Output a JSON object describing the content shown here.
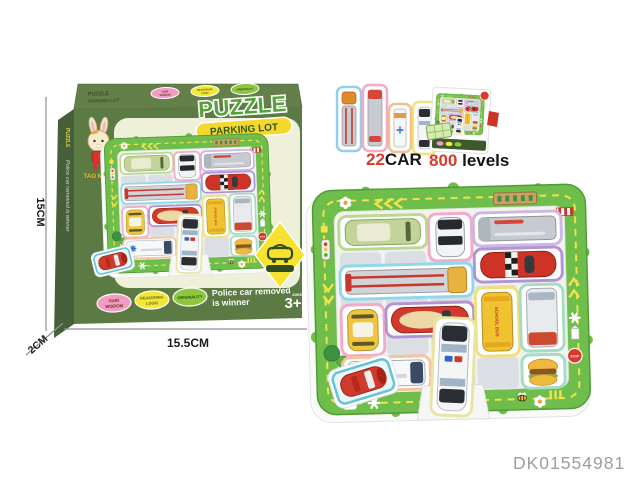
{
  "colors": {
    "box-olive": "#5c7a43",
    "box-olive-top": "#647f49",
    "box-olive-side": "#455f38",
    "box-cream": "#eef0da",
    "board-green": "#6fbe4b",
    "title-green": "#53a337",
    "ribbon-yellow": "#f6d72e",
    "red-accent": "#d93a2b",
    "code-gray": "#9b9ea2"
  },
  "product_code": "DK01554981",
  "box": {
    "title_line1": "PUZZLE",
    "title_line2": "PARKING LOT",
    "brand": "TAO MI TU",
    "side_text": "Police car removed is winner",
    "badges": [
      {
        "line1": "GAIN",
        "line2": "WISDOM",
        "color": "#f29bc4"
      },
      {
        "line1": "REASONING",
        "line2": "LOGIC",
        "color": "#f2e838"
      },
      {
        "line1": "ORIGINALITY",
        "line2": "",
        "color": "#8dc63f"
      }
    ],
    "tagline_line1": "Police car removed",
    "tagline_line2": "is winner",
    "age": "3+",
    "age_note": "AGES"
  },
  "dimensions": {
    "height": "15CM",
    "depth": "2CM",
    "width": "15.5CM"
  },
  "features": {
    "cars_value": "22",
    "cars_label": "CAR",
    "levels_value": "800",
    "levels_label": " levels"
  },
  "board": {
    "parking_sign": "P",
    "stop_sign": "STOP",
    "school_bus": "SCHOOL BUS"
  }
}
